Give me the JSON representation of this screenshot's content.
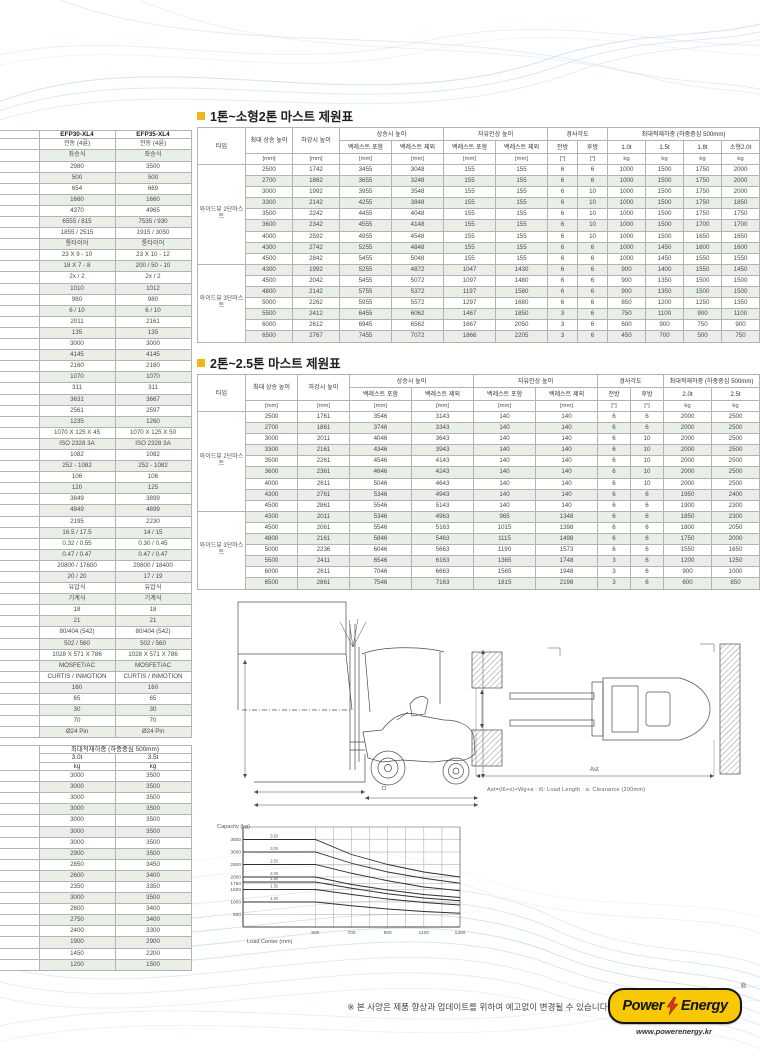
{
  "page": {
    "note": "※ 본 사양은 제품 향상과 업데이트를 위하여 예고없이 변경될 수 있습니다.",
    "logo": {
      "brand_left": "Power",
      "brand_right": "Energy",
      "reg": "®",
      "url": "www.powerenergy.kr"
    },
    "colors": {
      "accent_bullet": "#f2b70e",
      "row_shade": "#e9efe7",
      "logo_yellow": "#f8c800",
      "bolt_red": "#e0301e",
      "wave_blue": "#c9dfee"
    }
  },
  "left_spec_table": {
    "columns": [
      "EFP30-XL4",
      "EFP35-XL4"
    ],
    "rows": [
      [
        "전동 (4륜)",
        "전동 (4륜)"
      ],
      [
        "좌승식",
        "좌승식"
      ],
      [
        "2980",
        "3500"
      ],
      [
        "500",
        "500"
      ],
      [
        "654",
        "669"
      ],
      [
        "1660",
        "1660"
      ],
      [
        "4370",
        "4965"
      ],
      [
        "6555 / 815",
        "7535 / 930"
      ],
      [
        "1855 / 2515",
        "1915 / 3050"
      ],
      [
        "통타이어",
        "통타이어"
      ],
      [
        "23 X 9 - 10",
        "23 X 10 - 12"
      ],
      [
        "18 X 7 - 8",
        "200 / 50 - 10"
      ],
      [
        "2x / 2",
        "2x / 2"
      ],
      [
        "1010",
        "1012"
      ],
      [
        "980",
        "980"
      ],
      [
        "6 / 10",
        "6 / 10"
      ],
      [
        "2011",
        "2161"
      ],
      [
        "135",
        "135"
      ],
      [
        "3000",
        "3000"
      ],
      [
        "4145",
        "4145"
      ],
      [
        "2160",
        "2160"
      ],
      [
        "1070",
        "1070"
      ],
      [
        "311",
        "311"
      ],
      [
        "3631",
        "3667"
      ],
      [
        "2561",
        "2597"
      ],
      [
        "1235",
        "1260"
      ],
      [
        "1070 X 125 X 45",
        "1070 X 125 X 50"
      ],
      [
        "ISO 2328 3A",
        "ISO 2328 3A"
      ],
      [
        "1082",
        "1082"
      ],
      [
        "252 - 1082",
        "252 - 1082"
      ],
      [
        "106",
        "106"
      ],
      [
        "120",
        "125"
      ],
      [
        "3849",
        "3899"
      ],
      [
        "4849",
        "4899"
      ],
      [
        "2195",
        "2230"
      ],
      [
        "16.5 / 17.5",
        "14 / 15"
      ],
      [
        "0.32 / 0.55",
        "0.30 / 0.45"
      ],
      [
        "0.47 / 0.47",
        "0.47 / 0.47"
      ],
      [
        "20800 / 17600",
        "20800 / 18400"
      ],
      [
        "20 / 20",
        "17 / 19"
      ],
      [
        "유압식",
        "유압식"
      ],
      [
        "기계식",
        "기계식"
      ],
      [
        "18",
        "18"
      ],
      [
        "21",
        "21"
      ],
      [
        "80/404 (542)",
        "80/404 (542)"
      ],
      [
        "502 / 560",
        "502 / 560"
      ],
      [
        "1028 X 571 X 786",
        "1028 X 571 X 786"
      ],
      [
        "MOSFET/AC",
        "MOSFET/AC"
      ],
      [
        "CURTIS / INMOTION",
        "CURTIS / INMOTION"
      ],
      [
        "160",
        "160"
      ],
      [
        "65",
        "65"
      ],
      [
        "30",
        "30"
      ],
      [
        "70",
        "70"
      ],
      [
        "Ø24 Pin",
        "Ø24 Pin"
      ]
    ]
  },
  "left_capacity_table": {
    "header": "최대적재하중 (하중중심 500mm)",
    "columns": [
      "3.0t",
      "3.5t"
    ],
    "units": [
      "kg",
      "kg"
    ],
    "rows": [
      [
        "3000",
        "3500"
      ],
      [
        "3000",
        "3500"
      ],
      [
        "3000",
        "3500"
      ],
      [
        "3000",
        "3500"
      ],
      [
        "3000",
        "3500"
      ],
      [
        "3000",
        "3500"
      ],
      [
        "3000",
        "3500"
      ],
      [
        "2900",
        "3500"
      ],
      [
        "2850",
        "3450"
      ],
      [
        "2600",
        "3400"
      ],
      [
        "2350",
        "3350"
      ],
      [
        "3000",
        "3500"
      ],
      [
        "2800",
        "3400"
      ],
      [
        "2750",
        "3400"
      ],
      [
        "2400",
        "3300"
      ],
      [
        "1900",
        "2900"
      ],
      [
        "1450",
        "2200"
      ],
      [
        "1200",
        "1500"
      ]
    ]
  },
  "mast_table_1": {
    "title": "1톤~소형2톤 마스트 제원표",
    "headers": {
      "type": "타입",
      "max_lift": "최대 상승 높이",
      "lowered": "하강시 높이",
      "extended": "상승시 높이",
      "free_lift": "자유인상 높이",
      "tilt": "경사각도",
      "capacity": "최대적재하중 (하중중심 500mm)",
      "incl": "백레스트 포함",
      "excl": "백레스트 제외",
      "fwd": "전방",
      "bwd": "후방",
      "cap_cols": [
        "1.0t",
        "1.5t",
        "1.8t",
        "소형2.0t"
      ],
      "unit_mm": "[mm]",
      "unit_deg": "[°]",
      "unit_kg": "kg"
    },
    "groups": [
      {
        "label": "와이드뷰 2단마스트",
        "rows": [
          [
            "2500",
            "1742",
            "3455",
            "3048",
            "155",
            "155",
            "6",
            "6",
            "1000",
            "1500",
            "1750",
            "2000"
          ],
          [
            "2700",
            "1862",
            "3655",
            "3248",
            "155",
            "155",
            "6",
            "6",
            "1000",
            "1500",
            "1750",
            "2000"
          ],
          [
            "3000",
            "1992",
            "3955",
            "3548",
            "155",
            "155",
            "6",
            "10",
            "1000",
            "1500",
            "1750",
            "2000"
          ],
          [
            "3300",
            "2142",
            "4255",
            "3848",
            "155",
            "155",
            "6",
            "10",
            "1000",
            "1500",
            "1750",
            "1850"
          ],
          [
            "3500",
            "2242",
            "4455",
            "4048",
            "155",
            "155",
            "6",
            "10",
            "1000",
            "1500",
            "1750",
            "1750"
          ],
          [
            "3600",
            "2342",
            "4555",
            "4148",
            "155",
            "155",
            "6",
            "10",
            "1000",
            "1500",
            "1700",
            "1700"
          ],
          [
            "4000",
            "2592",
            "4955",
            "4548",
            "155",
            "155",
            "6",
            "10",
            "1000",
            "1500",
            "1650",
            "1650"
          ],
          [
            "4300",
            "2742",
            "5255",
            "4848",
            "155",
            "155",
            "6",
            "6",
            "1000",
            "1450",
            "1600",
            "1600"
          ],
          [
            "4500",
            "2842",
            "5455",
            "5048",
            "155",
            "155",
            "6",
            "6",
            "1000",
            "1450",
            "1550",
            "1550"
          ]
        ]
      },
      {
        "label": "와이드뷰 3단마스트",
        "rows": [
          [
            "4300",
            "1992",
            "5255",
            "4872",
            "1047",
            "1430",
            "6",
            "6",
            "900",
            "1400",
            "1550",
            "1450"
          ],
          [
            "4500",
            "2042",
            "5455",
            "5072",
            "1097",
            "1480",
            "6",
            "6",
            "900",
            "1350",
            "1500",
            "1500"
          ],
          [
            "4800",
            "2142",
            "5755",
            "5372",
            "1197",
            "1580",
            "6",
            "6",
            "900",
            "1350",
            "1500",
            "1500"
          ],
          [
            "5000",
            "2262",
            "5955",
            "5572",
            "1297",
            "1680",
            "6",
            "6",
            "850",
            "1200",
            "1250",
            "1350"
          ],
          [
            "5500",
            "2412",
            "6455",
            "6062",
            "1467",
            "1850",
            "3",
            "6",
            "750",
            "1100",
            "900",
            "1100"
          ],
          [
            "6000",
            "2612",
            "6945",
            "6562",
            "1667",
            "2050",
            "3",
            "6",
            "600",
            "900",
            "750",
            "900"
          ],
          [
            "6500",
            "2767",
            "7455",
            "7072",
            "1866",
            "2205",
            "3",
            "6",
            "450",
            "700",
            "500",
            "750"
          ]
        ]
      }
    ]
  },
  "mast_table_2": {
    "title": "2톤~2.5톤 마스트 제원표",
    "headers": {
      "type": "타입",
      "max_lift": "최대 상승 높이",
      "lowered": "하강시 높이",
      "extended": "상승시 높이",
      "free_lift": "자유인상 높이",
      "tilt": "경사각도",
      "capacity": "최대적재하중 (하중중심 500mm)",
      "incl": "백레스트 포함",
      "excl": "백레스트 제외",
      "fwd": "전방",
      "bwd": "후방",
      "cap_cols": [
        "2.0t",
        "2.5t"
      ],
      "unit_mm": "[mm]",
      "unit_deg": "[°]",
      "unit_kg": "kg"
    },
    "groups": [
      {
        "label": "와이드뷰 2단마스트",
        "rows": [
          [
            "2500",
            "1761",
            "3546",
            "3143",
            "140",
            "140",
            "6",
            "6",
            "2000",
            "2500"
          ],
          [
            "2700",
            "1861",
            "3746",
            "3343",
            "140",
            "140",
            "6",
            "6",
            "2000",
            "2500"
          ],
          [
            "3000",
            "2011",
            "4046",
            "3643",
            "140",
            "140",
            "6",
            "10",
            "2000",
            "2500"
          ],
          [
            "3300",
            "2161",
            "4346",
            "3943",
            "140",
            "140",
            "6",
            "10",
            "2000",
            "2500"
          ],
          [
            "3500",
            "2261",
            "4546",
            "4143",
            "140",
            "140",
            "6",
            "10",
            "2000",
            "2500"
          ],
          [
            "3600",
            "2361",
            "4646",
            "4243",
            "140",
            "140",
            "6",
            "10",
            "2000",
            "2500"
          ],
          [
            "4000",
            "2611",
            "5046",
            "4643",
            "140",
            "140",
            "6",
            "10",
            "2000",
            "2500"
          ],
          [
            "4300",
            "2761",
            "5346",
            "4943",
            "140",
            "140",
            "6",
            "6",
            "1950",
            "2400"
          ],
          [
            "4500",
            "2861",
            "5546",
            "5143",
            "140",
            "140",
            "6",
            "6",
            "1900",
            "2300"
          ]
        ]
      },
      {
        "label": "와이드뷰 3단마스트",
        "rows": [
          [
            "4300",
            "2011",
            "5346",
            "4963",
            "965",
            "1348",
            "6",
            "6",
            "1850",
            "2300"
          ],
          [
            "4500",
            "2061",
            "5546",
            "5163",
            "1015",
            "1398",
            "6",
            "6",
            "1800",
            "2050"
          ],
          [
            "4800",
            "2161",
            "5846",
            "5463",
            "1115",
            "1498",
            "6",
            "6",
            "1750",
            "2000"
          ],
          [
            "5000",
            "2236",
            "6046",
            "5663",
            "1190",
            "1573",
            "6",
            "6",
            "1550",
            "1650"
          ],
          [
            "5500",
            "2411",
            "6546",
            "6163",
            "1365",
            "1748",
            "3",
            "6",
            "1200",
            "1250"
          ],
          [
            "6000",
            "2611",
            "7046",
            "6663",
            "1565",
            "1948",
            "3",
            "6",
            "900",
            "1000"
          ],
          [
            "6500",
            "2861",
            "7546",
            "7163",
            "1815",
            "2198",
            "3",
            "6",
            "600",
            "850"
          ]
        ]
      }
    ]
  },
  "diagrams": {
    "caption": "Ast=(l6+x)+Wg+a : l6: Load Length : a: Clearance (200mm)",
    "ast_label": "Ast"
  },
  "chart_data": {
    "type": "line",
    "title": "Capacity (kg)",
    "xlabel": "Load Center (mm)",
    "ylabel": "",
    "x": [
      100,
      500,
      700,
      900,
      1100,
      1300
    ],
    "x_ticks": [
      500,
      700,
      900,
      1100,
      1300
    ],
    "y_ticks": [
      500,
      1000,
      1500,
      1750,
      2000,
      2500,
      3000,
      3500
    ],
    "ylim": [
      0,
      4000
    ],
    "xlim": [
      100,
      1300
    ],
    "grid": true,
    "legend_position": "inline-left",
    "series": [
      {
        "name": "3.5t",
        "values": [
          3500,
          3500,
          2900,
          2500,
          2200,
          2000
        ]
      },
      {
        "name": "3.0t",
        "values": [
          3000,
          3000,
          2550,
          2200,
          1950,
          1750
        ]
      },
      {
        "name": "2.5t",
        "values": [
          2500,
          2500,
          2150,
          1850,
          1600,
          1450
        ]
      },
      {
        "name": "2.0t",
        "values": [
          2000,
          2000,
          1700,
          1480,
          1300,
          1180
        ]
      },
      {
        "name": "1.8t",
        "values": [
          1800,
          1800,
          1550,
          1330,
          1160,
          1050
        ]
      },
      {
        "name": "1.5t",
        "values": [
          1500,
          1500,
          1300,
          1120,
          980,
          880
        ]
      },
      {
        "name": "1.0t",
        "values": [
          1000,
          1000,
          850,
          720,
          620,
          550
        ]
      }
    ]
  }
}
